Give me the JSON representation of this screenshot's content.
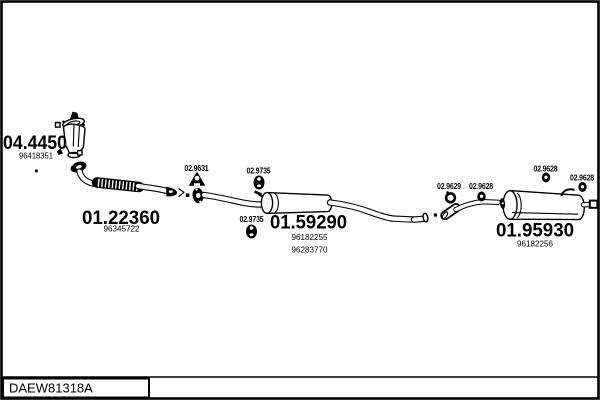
{
  "footer": {
    "drawing_code": "DAEW81318A"
  },
  "parts": {
    "catalyst": {
      "number": "04.4450",
      "ref": "96418351"
    },
    "front_pipe": {
      "number": "01.22360",
      "ref": "96345722"
    },
    "hanger_bracket": {
      "number": "02.9631"
    },
    "rubber_mount_front": {
      "number": "02.9735"
    },
    "rubber_mount_rear": {
      "number": "02.9735"
    },
    "centre_silencer": {
      "number": "01.59290",
      "ref1": "96182255",
      "ref2": "96283770"
    },
    "clamp": {
      "number": "02.9629"
    },
    "grommet_joint": {
      "number": "02.9628"
    },
    "grommet_mid": {
      "number": "02.9628"
    },
    "grommet_tail": {
      "number": "02.9628"
    },
    "rear_silencer": {
      "number": "01.95930",
      "ref": "96182256"
    }
  }
}
